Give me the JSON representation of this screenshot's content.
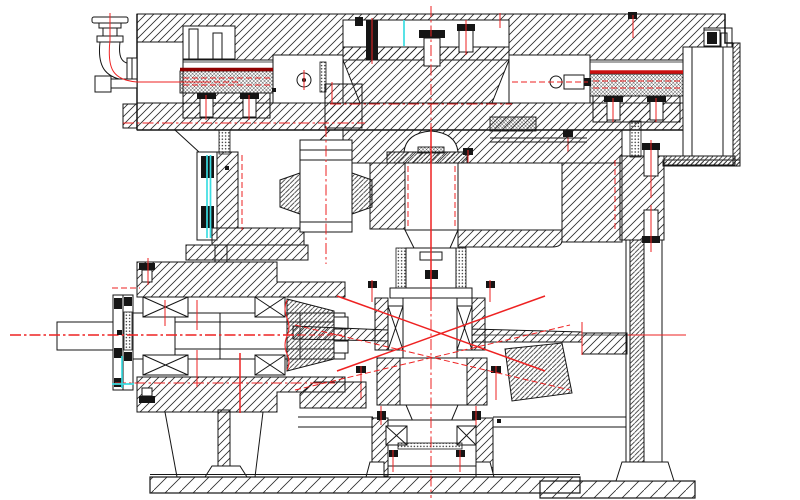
{
  "page": {
    "width": 800,
    "height": 500,
    "background": "#ffffff"
  },
  "drawing": {
    "description": "Black-and-white sectional CAD assembly drawing of a worm-gear rotary table: top worm-wheel housing with lubrication pipe, central vertical output shaft with dome cap and rolling bearings, left horizontal input shaft with bevel pinion, right support column and base plates. Red dash-dot centerlines, dark-red worm crest lines and cyan seal highlights.",
    "colors": {
      "line": "#151515",
      "hatch": "#2c2c2c",
      "centerline_red": "#ee2222",
      "worm_cap_left_dark_red": "#8e0000",
      "worm_cap_right_red": "#cc1010",
      "highlight_cyan": "#3adde2",
      "knurl_gray": "#3c3c3c",
      "background": "#ffffff"
    }
  }
}
